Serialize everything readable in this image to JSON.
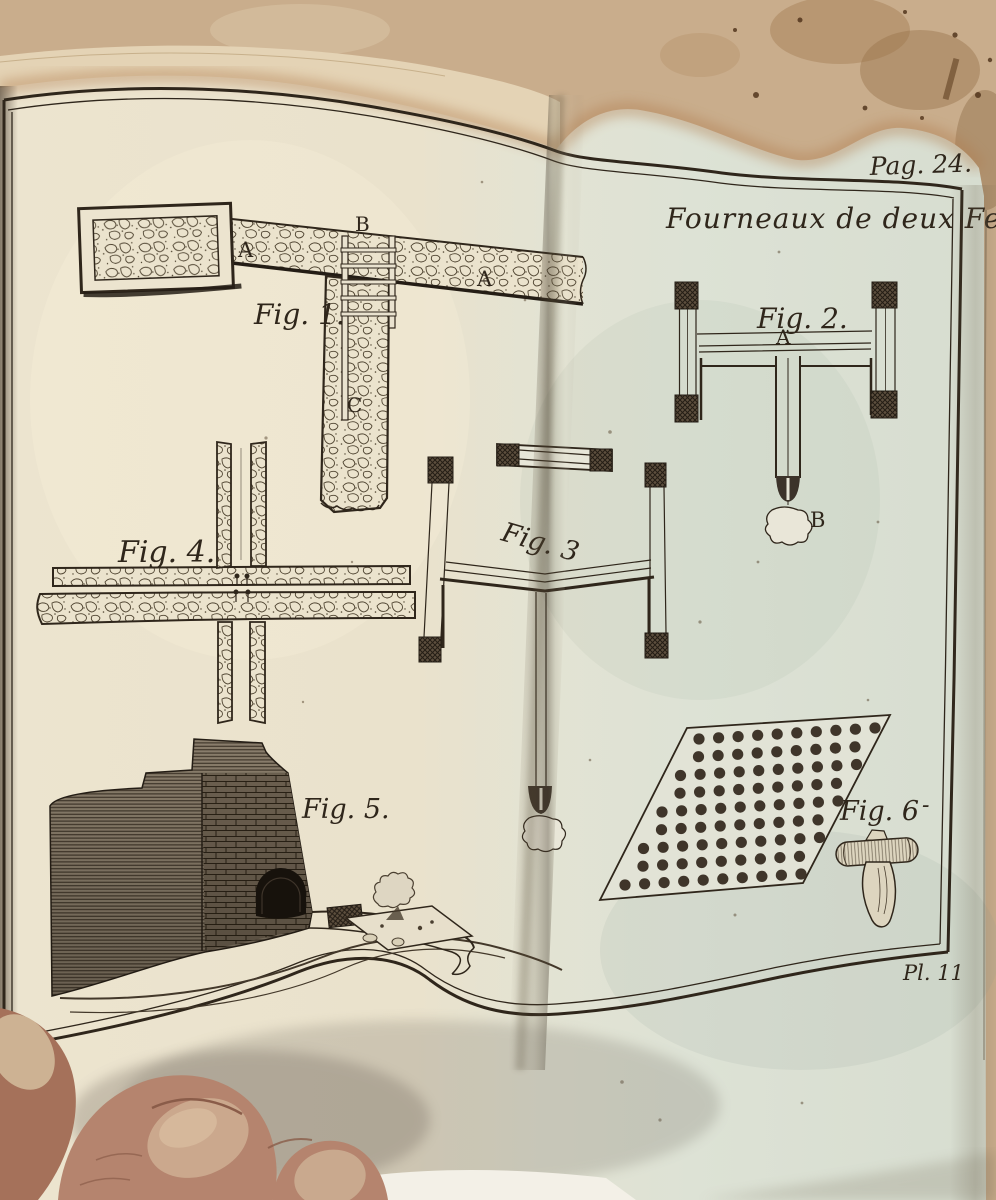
{
  "plate": {
    "page_ref": "Pag. 24.",
    "title": "Fourneaux de deux Feux",
    "plate_ref": "Pl. 11",
    "figures": {
      "fig1": {
        "label": "Fig. 1.",
        "letter_a_left": "A",
        "letter_b": "B",
        "letter_a_right": "A",
        "letter_c": "C"
      },
      "fig2": {
        "label": "Fig. 2.",
        "letter_a": "A",
        "letter_b": "B"
      },
      "fig3": {
        "label": "Fig. 3"
      },
      "fig4": {
        "label": "Fig. 4."
      },
      "fig5": {
        "label": "Fig. 5."
      },
      "fig6": {
        "label": "Fig. 6",
        "dash": "-"
      }
    }
  },
  "colors": {
    "background_paper": "#c9ad8c",
    "underlay_page": "#e4d3b5",
    "page_left": "#ece4cf",
    "page_right": "#d7ddd0",
    "ink": "#2f261b",
    "skin": "#b5846e",
    "nail": "#cba88d"
  }
}
